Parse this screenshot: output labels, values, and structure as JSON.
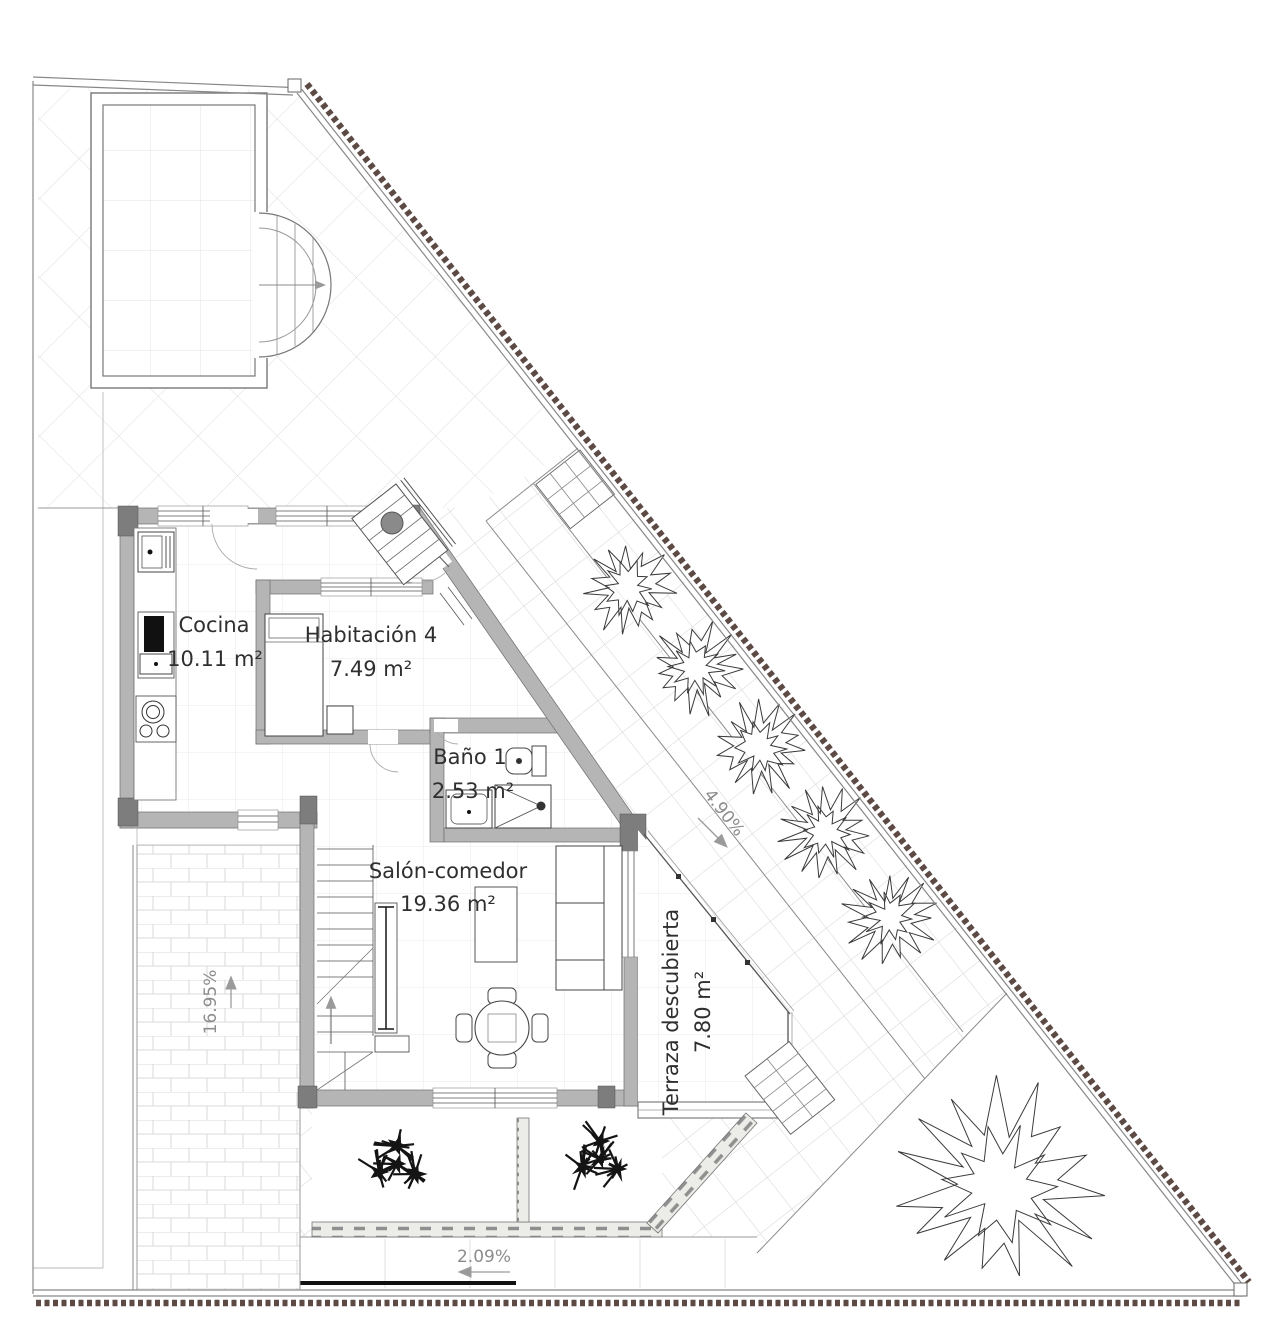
{
  "plan": {
    "title": "Planta vivienda - plano de distribución",
    "rooms": {
      "cocina": {
        "name": "Cocina",
        "area": "10.11 m²"
      },
      "habitacion4": {
        "name": "Habitación 4",
        "area": "7.49 m²"
      },
      "bano1": {
        "name": "Baño 1",
        "area": "2.53 m²"
      },
      "salon": {
        "name": "Salón-comedor",
        "area": "19.36 m²"
      },
      "terraza": {
        "name": "Terraza descubierta",
        "area": "7.80 m²"
      }
    },
    "slopes": {
      "driveway_ramp": "16.95%",
      "side_path": "4.90%",
      "sidewalk": "2.09%"
    },
    "colors": {
      "wall_fill": "#b5b5b5",
      "wall_dark": "#7d7d7d",
      "fence_dots": "#5d4a45",
      "line": "#555555",
      "grid_light": "#dcdcdc",
      "room_label": "#2f2f2f",
      "slope_label": "#8c8c8c"
    }
  }
}
